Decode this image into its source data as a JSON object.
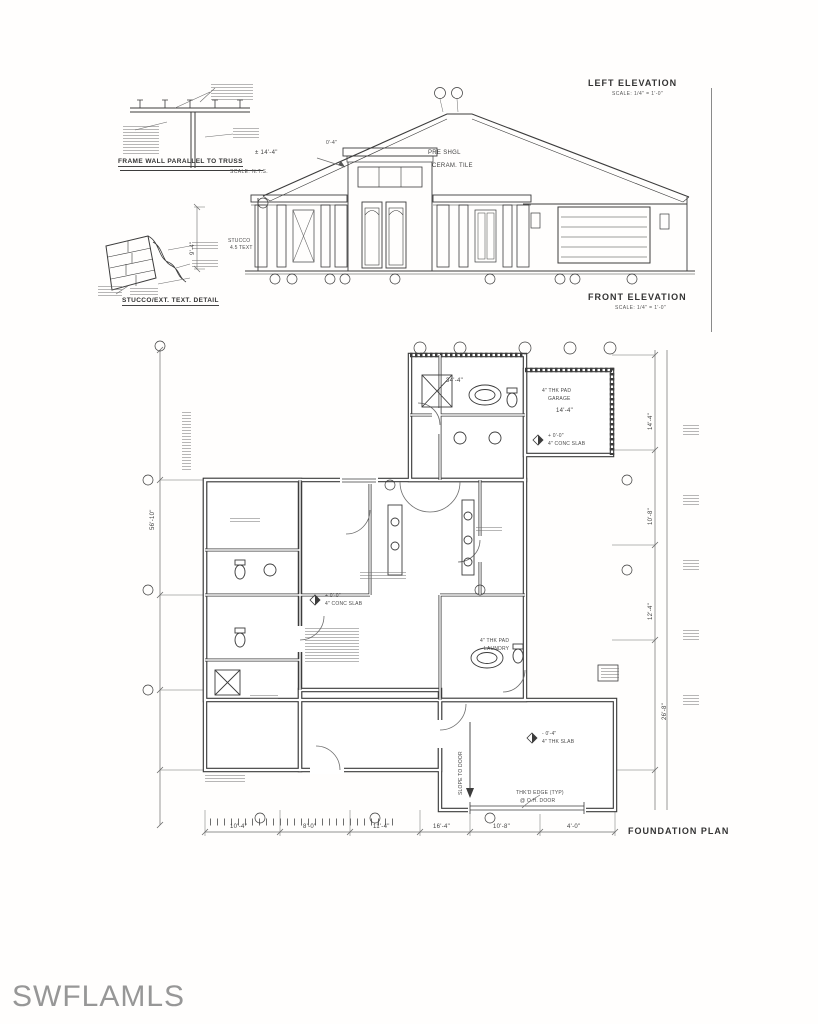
{
  "page": {
    "watermark": "SWFLAMLS"
  },
  "truss_detail": {
    "caption": "FRAME WALL PARALLEL TO TRUSS",
    "scale": "SCALE: N.T.S."
  },
  "stucco_detail": {
    "caption": "STUCCO/EXT. TEXT. DETAIL"
  },
  "left_elevation": {
    "title": "LEFT ELEVATION",
    "scale": "SCALE: 1/4\" = 1'-0\""
  },
  "front_elevation": {
    "title": "FRONT ELEVATION",
    "scale": "SCALE: 1/4\" = 1'-0\"",
    "roof_note_line1": "PRE SHGL",
    "roof_note_line2": "CERAM. TILE",
    "ridge_dim": "± 14'-4\"",
    "eave_dim": "0'-4\"",
    "wall_height_dim": "9'-4\"",
    "wall_note_line1": "STUCCO",
    "wall_note_line2": "4.5 TEXT"
  },
  "foundation_plan": {
    "title": "FOUNDATION PLAN",
    "garage_pad_note_line1": "4\" THK PAD",
    "garage_pad_note_line2": "GARAGE",
    "garage_wing_dim": "14'-4\"",
    "upper_dim": "34'-4\"",
    "marker_a_label": "+ 0'-0\"",
    "marker_a_note": "4\" CONC SLAB",
    "marker_b_label": "+ 0'-0\"",
    "marker_b_note": "4\" CONC SLAB",
    "marker_c_label": "- 0'-4\"",
    "marker_c_note": "4\" THK SLAB",
    "laundry_note_line1": "4\" THK PAD",
    "laundry_note_line2": "LAUNDRY",
    "slope_note": "SLOPE TO DOOR",
    "ohdoor_note_line1": "THK'D EDGE (TYP)",
    "ohdoor_note_line2": "@ O.H. DOOR",
    "left_dim": "56'-10\"",
    "right_dims": [
      "14'-4\"",
      "10'-8\"",
      "12'-4\"",
      "26'-8\""
    ],
    "bottom_dims": [
      "10'-4\"",
      "8'-0\"",
      "11'-4\"",
      "16'-4\"",
      "10'-8\"",
      "4'-0\""
    ]
  }
}
